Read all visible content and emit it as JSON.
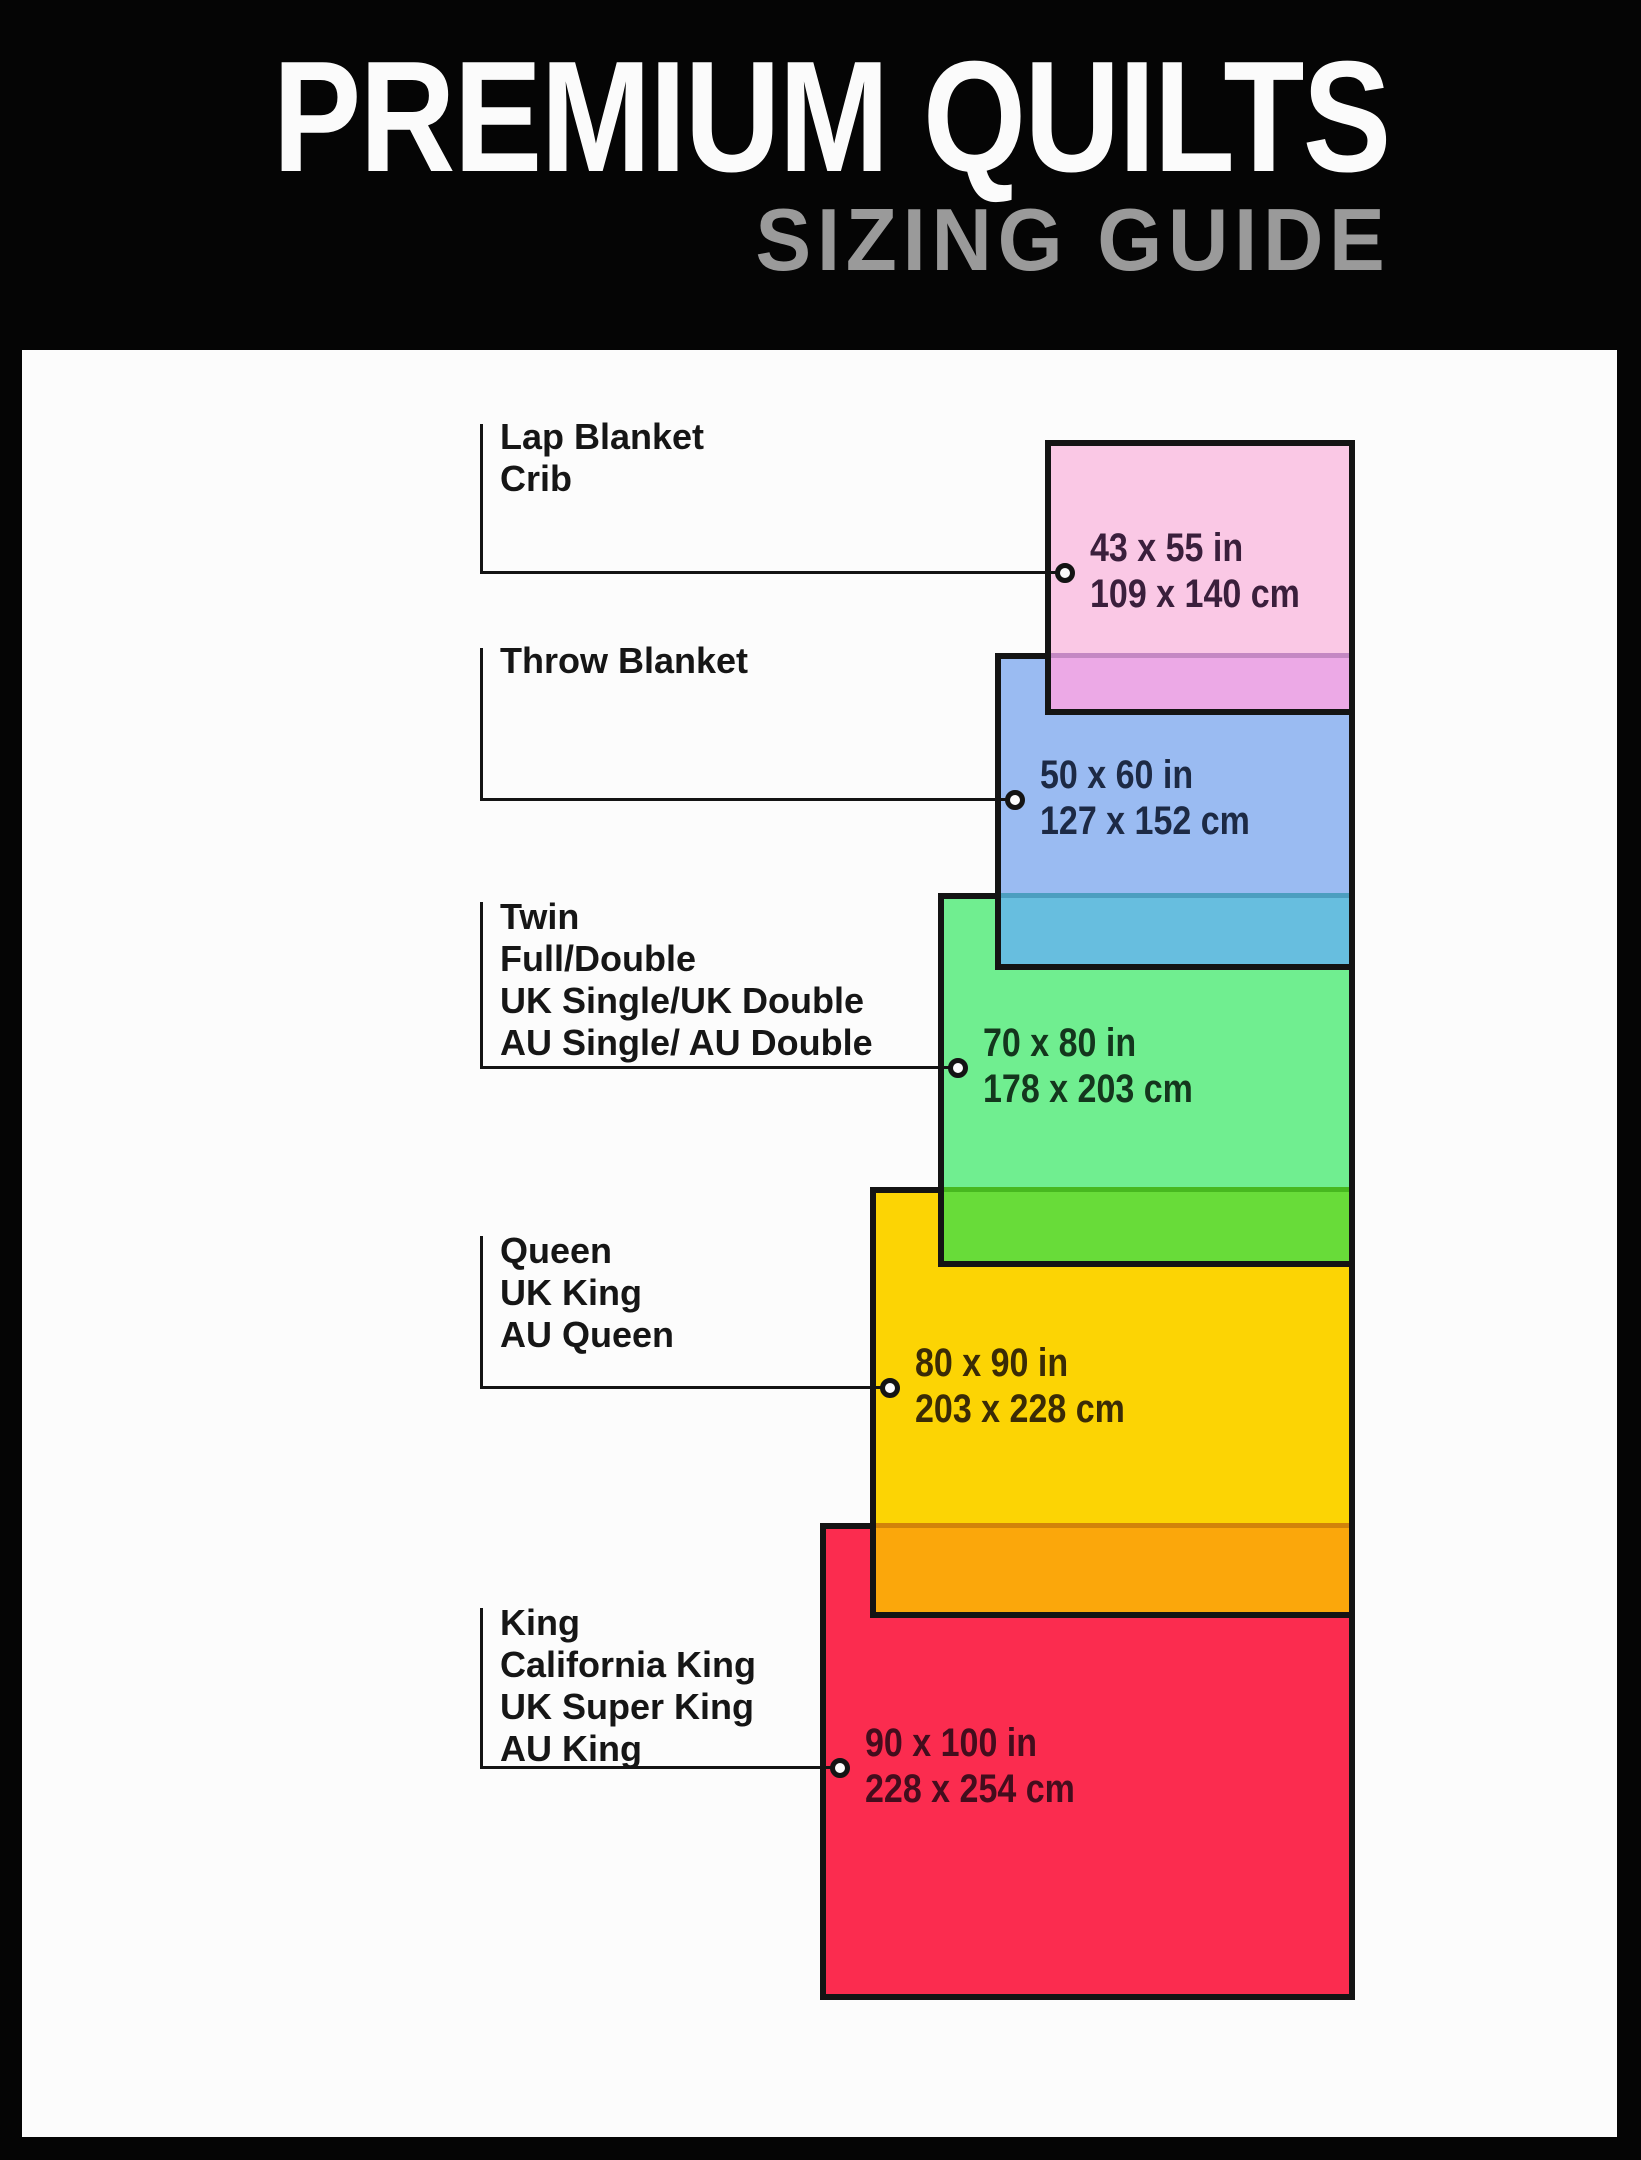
{
  "header": {
    "title": "PREMIUM QUILTS",
    "subtitle": "SIZING GUIDE",
    "background_color": "#050505",
    "title_color": "#FBFBFB",
    "subtitle_color": "#9A9A9A"
  },
  "canvas": {
    "panel_color": "#FCFCFC",
    "line_color": "#141414",
    "border_color": "#141414"
  },
  "sizes": [
    {
      "id": "lap-blanket-crib",
      "labels": [
        "Lap Blanket",
        "Crib"
      ],
      "inches": "43 x 55 in",
      "cm": "109 x 140 cm",
      "fill": "#FAC8E5",
      "overlap_fill": "#ECA9E6",
      "overlap_line": "#C488C3",
      "text_color": "#3A1F3C"
    },
    {
      "id": "throw-blanket",
      "labels": [
        "Throw Blanket"
      ],
      "inches": "50 x 60 in",
      "cm": "127 x 152 cm",
      "fill": "#9ABBF2",
      "overlap_fill": "#67BEDF",
      "overlap_line": "#4C9EC0",
      "text_color": "#1D2A45"
    },
    {
      "id": "twin-full-double",
      "labels": [
        "Twin",
        "Full/Double",
        "UK Single/UK Double",
        "AU Single/ AU Double"
      ],
      "inches": "70 x 80 in",
      "cm": "178 x 203 cm",
      "fill": "#70EE90",
      "overlap_fill": "#68DC39",
      "overlap_line": "#47B81F",
      "text_color": "#14361D"
    },
    {
      "id": "queen",
      "labels": [
        "Queen",
        "UK King",
        "AU Queen"
      ],
      "inches": "80 x 90 in",
      "cm": "203 x 228 cm",
      "fill": "#FCD404",
      "overlap_fill": "#FBA70B",
      "overlap_line": "#D2830A",
      "text_color": "#3A2B06"
    },
    {
      "id": "king",
      "labels": [
        "King",
        "California King",
        "UK Super King",
        "AU King"
      ],
      "inches": "90 x 100 in",
      "cm": "228 x 254 cm",
      "fill": "#FB2C4F",
      "overlap_fill": null,
      "overlap_line": null,
      "text_color": "#430D1D"
    }
  ]
}
